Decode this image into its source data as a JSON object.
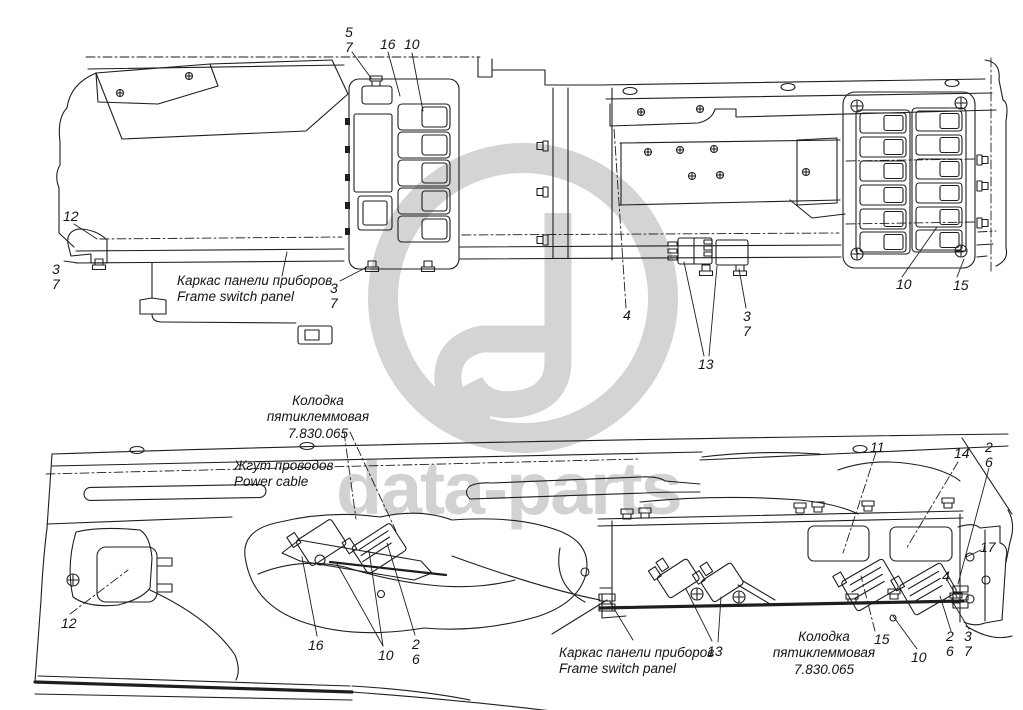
{
  "watermark": {
    "text": "data-parts",
    "logo_color": "#d4d4d4",
    "text_color": "#d2d2d2"
  },
  "colors": {
    "line": "#1e1e1e",
    "background": "#ffffff"
  },
  "top_view": {
    "labels": {
      "frame_panel": "Каркас панели приборов\nFrame switch panel"
    },
    "callouts": {
      "c5_7": "5\n7",
      "c16": "16",
      "c10_left": "10",
      "c12": "12",
      "c3_7_left": "3\n7",
      "c3_7_panel": "3\n7",
      "c4": "4",
      "c3_7_mid": "3\n7",
      "c13": "13",
      "c10_right": "10",
      "c15": "15"
    }
  },
  "bottom_view": {
    "labels": {
      "block_left": "Колодка\nпятиклеммовая\n7.830.065",
      "power_cable": "Жгут проводов\nPower cable",
      "frame_panel": "Каркас панели приборов\nFrame switch panel",
      "block_right": "Колодка\nпятиклеммовая\n7.830.065"
    },
    "callouts": {
      "c12": "12",
      "c16": "16",
      "c10_center": "10",
      "c2_6_center": "2\n6",
      "c11": "11",
      "c14": "14",
      "c2_6_top": "2\n6",
      "c17": "17",
      "c4": "4",
      "c13": "13",
      "c15": "15",
      "c10_right": "10",
      "c2_6_right": "2\n6",
      "c3_7_right": "3\n7"
    }
  }
}
